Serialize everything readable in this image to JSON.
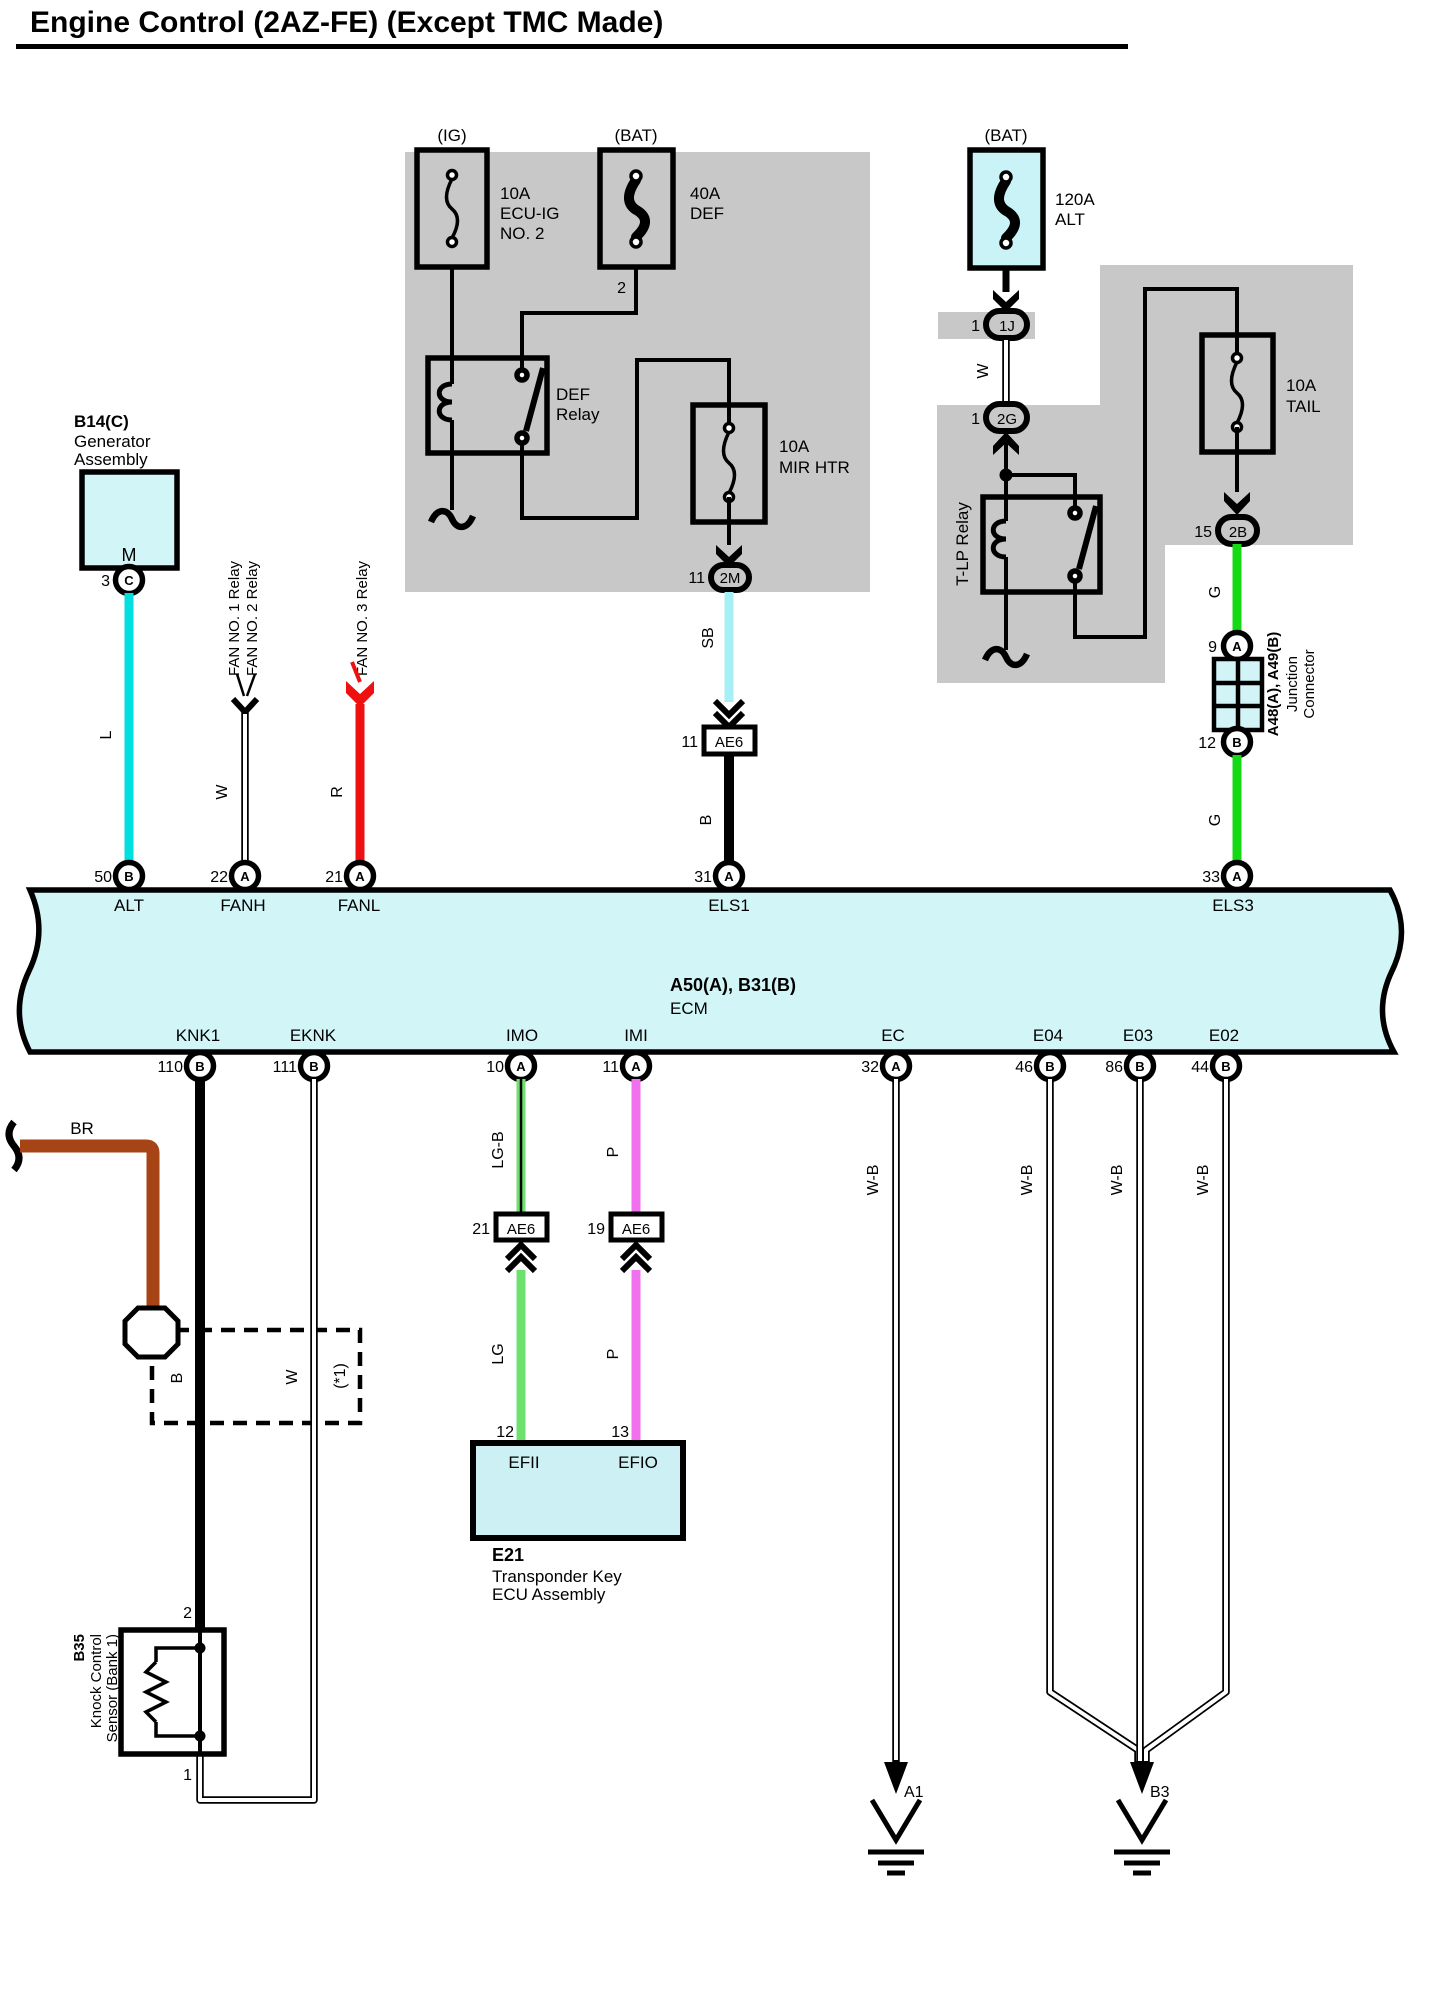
{
  "title": "Engine Control (2AZ-FE) (Except TMC Made)",
  "colors": {
    "panel_gray": "#c8c8c8",
    "component_fill": "#d2f6f8",
    "wire_cyan": "#00dede",
    "wire_red": "#ee1111",
    "wire_skyblue": "#a5eff5",
    "wire_green": "#16d916",
    "wire_light_green": "#6ee06e",
    "wire_pink": "#f070ee",
    "wire_brown": "#a64415",
    "wire_black": "#000000"
  },
  "fuses": {
    "ecu_ig": {
      "bus": "(IG)",
      "rating": "10A",
      "name1": "ECU-IG",
      "name2": "NO. 2"
    },
    "def": {
      "bus": "(BAT)",
      "rating": "40A",
      "name": "DEF",
      "pin_out": "2"
    },
    "alt": {
      "bus": "(BAT)",
      "rating": "120A",
      "name": "ALT"
    },
    "mir_htr": {
      "rating": "10A",
      "name": "MIR HTR"
    },
    "tail": {
      "rating": "10A",
      "name": "TAIL"
    }
  },
  "relays": {
    "def": {
      "name1": "DEF",
      "name2": "Relay"
    },
    "tlp": {
      "name": "T-LP Relay"
    }
  },
  "fan_relays": {
    "fan1": "FAN NO. 1 Relay",
    "fan2": "FAN NO. 2 Relay",
    "fan3": "FAN NO. 3 Relay"
  },
  "generator": {
    "id": "B14(C)",
    "name1": "Generator",
    "name2": "Assembly",
    "symbol": "M",
    "pin": "3",
    "pin_code": "C"
  },
  "connectors": {
    "c1j": {
      "pin": "1",
      "code": "1J"
    },
    "c2g": {
      "pin": "1",
      "code": "2G"
    },
    "c2m": {
      "pin": "11",
      "code": "2M"
    },
    "c2b": {
      "pin": "15",
      "code": "2B"
    },
    "ae6_els": {
      "pin": "11",
      "code": "AE6"
    },
    "ae6_imo": {
      "pin": "21",
      "code": "AE6"
    },
    "ae6_imi": {
      "pin": "19",
      "code": "AE6"
    },
    "junction": {
      "pin_top": "9",
      "pin_top_code": "A",
      "pin_bot": "12",
      "pin_bot_code": "B",
      "id": "A48(A), A49(B)",
      "name1": "Junction",
      "name2": "Connector"
    }
  },
  "wire_labels": {
    "l": "L",
    "w_fan": "W",
    "r_fan": "R",
    "w_alt": "W",
    "sb": "SB",
    "b_els": "B",
    "g_top": "G",
    "g_bot": "G",
    "br": "BR",
    "b_knk": "B",
    "w_eknk": "W",
    "note": "(*1)",
    "lg_b": "LG-B",
    "p_top": "P",
    "lg": "LG",
    "p_bot": "P",
    "wb_ec": "W-B",
    "wb_e04": "W-B",
    "wb_e03": "W-B",
    "wb_e02": "W-B"
  },
  "ecm": {
    "id": "A50(A), B31(B)",
    "name": "ECM",
    "top_pins": [
      {
        "num": "50",
        "code": "B",
        "label": "ALT"
      },
      {
        "num": "22",
        "code": "A",
        "label": "FANH"
      },
      {
        "num": "21",
        "code": "A",
        "label": "FANL"
      },
      {
        "num": "31",
        "code": "A",
        "label": "ELS1"
      },
      {
        "num": "33",
        "code": "A",
        "label": "ELS3"
      }
    ],
    "bottom_pins": [
      {
        "num": "110",
        "code": "B",
        "label": "KNK1"
      },
      {
        "num": "111",
        "code": "B",
        "label": "EKNK"
      },
      {
        "num": "10",
        "code": "A",
        "label": "IMO"
      },
      {
        "num": "11",
        "code": "A",
        "label": "IMI"
      },
      {
        "num": "32",
        "code": "A",
        "label": "EC"
      },
      {
        "num": "46",
        "code": "B",
        "label": "E04"
      },
      {
        "num": "86",
        "code": "B",
        "label": "E03"
      },
      {
        "num": "44",
        "code": "B",
        "label": "E02"
      }
    ]
  },
  "knock_sensor": {
    "id": "B35",
    "name1": "Knock Control",
    "name2": "Sensor (Bank 1)",
    "pin_top": "2",
    "pin_bot": "1"
  },
  "transponder": {
    "id": "E21",
    "name1": "Transponder Key",
    "name2": "ECU Assembly",
    "pin_left": "12",
    "pin_left_label": "EFII",
    "pin_right": "13",
    "pin_right_label": "EFIO"
  },
  "grounds": {
    "a1": "A1",
    "b3": "B3"
  }
}
